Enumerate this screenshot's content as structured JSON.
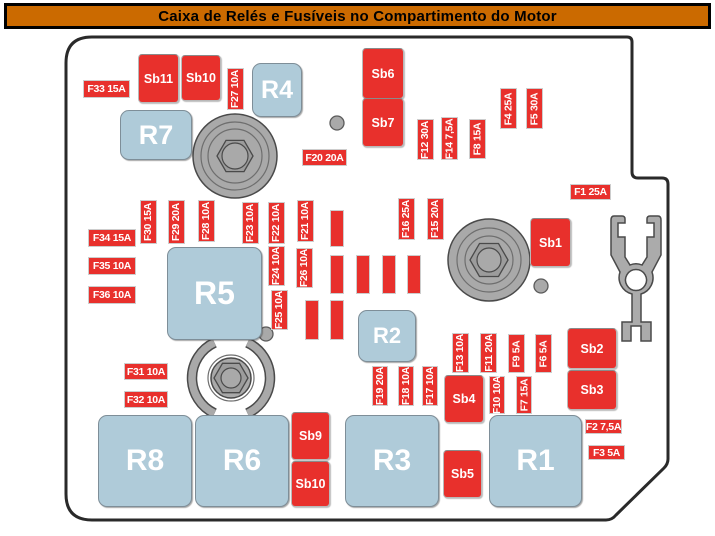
{
  "title": "Caixa de Relés e Fusíveis no Compartimento do Motor",
  "colors": {
    "title_bg": "#CB6A00",
    "fuse_red": "#E8302C",
    "relay_blue": "#AFCBD9",
    "metal_gray": "#A9A9A9",
    "metal_dark": "#4A4A4A",
    "outline": "#2A2A2A"
  },
  "diagram": {
    "relays": [
      {
        "label": "R4",
        "x": 252,
        "y": 63,
        "w": 48,
        "h": 52,
        "fs": 25
      },
      {
        "label": "R7",
        "x": 120,
        "y": 110,
        "w": 70,
        "h": 48,
        "fs": 27
      },
      {
        "label": "R5",
        "x": 167,
        "y": 247,
        "w": 93,
        "h": 91,
        "fs": 32
      },
      {
        "label": "R2",
        "x": 358,
        "y": 310,
        "w": 56,
        "h": 50,
        "fs": 22
      },
      {
        "label": "R8",
        "x": 98,
        "y": 415,
        "w": 92,
        "h": 90,
        "fs": 30
      },
      {
        "label": "R6",
        "x": 195,
        "y": 415,
        "w": 92,
        "h": 90,
        "fs": 30
      },
      {
        "label": "R3",
        "x": 345,
        "y": 415,
        "w": 92,
        "h": 90,
        "fs": 30
      },
      {
        "label": "R1",
        "x": 489,
        "y": 415,
        "w": 91,
        "h": 90,
        "fs": 30
      }
    ],
    "sb_fuses": [
      {
        "label": "Sb11",
        "x": 138,
        "y": 54,
        "w": 39,
        "h": 47
      },
      {
        "label": "Sb10",
        "x": 181,
        "y": 55,
        "w": 38,
        "h": 44
      },
      {
        "label": "Sb6",
        "x": 362,
        "y": 48,
        "w": 40,
        "h": 49
      },
      {
        "label": "Sb7",
        "x": 362,
        "y": 98,
        "w": 40,
        "h": 47
      },
      {
        "label": "Sb1",
        "x": 530,
        "y": 218,
        "w": 39,
        "h": 47
      },
      {
        "label": "Sb2",
        "x": 567,
        "y": 328,
        "w": 48,
        "h": 39
      },
      {
        "label": "Sb3",
        "x": 567,
        "y": 370,
        "w": 48,
        "h": 38
      },
      {
        "label": "Sb4",
        "x": 444,
        "y": 375,
        "w": 38,
        "h": 46
      },
      {
        "label": "Sb5",
        "x": 443,
        "y": 450,
        "w": 37,
        "h": 46
      },
      {
        "label": "Sb9",
        "x": 291,
        "y": 412,
        "w": 37,
        "h": 46
      },
      {
        "label": "Sb10",
        "x": 291,
        "y": 461,
        "w": 37,
        "h": 44
      }
    ],
    "fuse_labels_h": [
      {
        "label": "F33 15A",
        "x": 83,
        "y": 80,
        "w": 45,
        "h": 16
      },
      {
        "label": "F34 15A",
        "x": 88,
        "y": 229,
        "w": 46,
        "h": 16
      },
      {
        "label": "F35 10A",
        "x": 88,
        "y": 257,
        "w": 46,
        "h": 16
      },
      {
        "label": "F36 10A",
        "x": 88,
        "y": 286,
        "w": 46,
        "h": 16
      },
      {
        "label": "F31 10A",
        "x": 124,
        "y": 363,
        "w": 42,
        "h": 15
      },
      {
        "label": "F32 10A",
        "x": 124,
        "y": 391,
        "w": 42,
        "h": 15
      },
      {
        "label": "F20 20A",
        "x": 302,
        "y": 149,
        "w": 43,
        "h": 15
      },
      {
        "label": "F1 25A",
        "x": 570,
        "y": 184,
        "w": 39,
        "h": 14
      },
      {
        "label": "F2 7,5A",
        "x": 585,
        "y": 419,
        "w": 35,
        "h": 13
      },
      {
        "label": "F3 5A",
        "x": 588,
        "y": 445,
        "w": 35,
        "h": 13
      }
    ],
    "fuse_labels_v": [
      {
        "label": "F27 10A",
        "x": 227,
        "y": 68,
        "w": 15,
        "h": 40
      },
      {
        "label": "F12 30A",
        "x": 417,
        "y": 119,
        "w": 15,
        "h": 39
      },
      {
        "label": "F14 7,5A",
        "x": 441,
        "y": 117,
        "w": 15,
        "h": 41
      },
      {
        "label": "F8 15A",
        "x": 469,
        "y": 119,
        "w": 15,
        "h": 38
      },
      {
        "label": "F4 25A",
        "x": 500,
        "y": 88,
        "w": 15,
        "h": 39
      },
      {
        "label": "F5 30A",
        "x": 526,
        "y": 88,
        "w": 15,
        "h": 39
      },
      {
        "label": "F30 15A",
        "x": 140,
        "y": 200,
        "w": 15,
        "h": 42
      },
      {
        "label": "F29 20A",
        "x": 168,
        "y": 200,
        "w": 15,
        "h": 42
      },
      {
        "label": "F28 10A",
        "x": 198,
        "y": 200,
        "w": 15,
        "h": 40
      },
      {
        "label": "F23 10A",
        "x": 242,
        "y": 202,
        "w": 15,
        "h": 40
      },
      {
        "label": "F22 10A",
        "x": 268,
        "y": 202,
        "w": 15,
        "h": 40
      },
      {
        "label": "F21 10A",
        "x": 297,
        "y": 200,
        "w": 15,
        "h": 40
      },
      {
        "label": "F24 10A",
        "x": 268,
        "y": 246,
        "w": 15,
        "h": 38
      },
      {
        "label": "F26 10A",
        "x": 296,
        "y": 248,
        "w": 15,
        "h": 38
      },
      {
        "label": "F25 10A",
        "x": 271,
        "y": 290,
        "w": 15,
        "h": 38
      },
      {
        "label": "F16 25A",
        "x": 398,
        "y": 198,
        "w": 15,
        "h": 40
      },
      {
        "label": "F15 20A",
        "x": 427,
        "y": 198,
        "w": 15,
        "h": 40
      },
      {
        "label": "F19 20A",
        "x": 372,
        "y": 366,
        "w": 14,
        "h": 38
      },
      {
        "label": "F18 10A",
        "x": 398,
        "y": 366,
        "w": 14,
        "h": 38
      },
      {
        "label": "F17 10A",
        "x": 422,
        "y": 366,
        "w": 14,
        "h": 38
      },
      {
        "label": "F13 10A",
        "x": 452,
        "y": 333,
        "w": 15,
        "h": 38
      },
      {
        "label": "F11 20A",
        "x": 480,
        "y": 333,
        "w": 15,
        "h": 38
      },
      {
        "label": "F9 5A",
        "x": 508,
        "y": 334,
        "w": 15,
        "h": 37
      },
      {
        "label": "F6 5A",
        "x": 535,
        "y": 334,
        "w": 15,
        "h": 37
      },
      {
        "label": "F10 10A",
        "x": 489,
        "y": 376,
        "w": 14,
        "h": 36
      },
      {
        "label": "F7 15A",
        "x": 516,
        "y": 376,
        "w": 14,
        "h": 36
      }
    ],
    "empty_slots": [
      {
        "x": 330,
        "y": 210,
        "w": 12,
        "h": 35
      },
      {
        "x": 330,
        "y": 255,
        "w": 12,
        "h": 37
      },
      {
        "x": 356,
        "y": 255,
        "w": 12,
        "h": 37
      },
      {
        "x": 382,
        "y": 255,
        "w": 12,
        "h": 37
      },
      {
        "x": 407,
        "y": 255,
        "w": 12,
        "h": 37
      },
      {
        "x": 305,
        "y": 300,
        "w": 12,
        "h": 38
      },
      {
        "x": 330,
        "y": 300,
        "w": 12,
        "h": 38
      }
    ],
    "bolts": [
      {
        "cx": 235,
        "cy": 156,
        "outer": 42,
        "rings": [
          34,
          27
        ],
        "hex": 18,
        "inner": 13
      },
      {
        "cx": 489,
        "cy": 260,
        "outer": 41,
        "rings": [
          32,
          24
        ],
        "hex": 19,
        "inner": 12
      },
      {
        "cx": 231,
        "cy": 378,
        "outer": 20,
        "rings": [
          23
        ],
        "hex": 17,
        "inner": 10,
        "arcs": 39
      }
    ],
    "screws": [
      {
        "cx": 337,
        "cy": 123,
        "r": 7
      },
      {
        "cx": 266,
        "cy": 334,
        "r": 7
      },
      {
        "cx": 541,
        "cy": 286,
        "r": 7
      }
    ]
  }
}
